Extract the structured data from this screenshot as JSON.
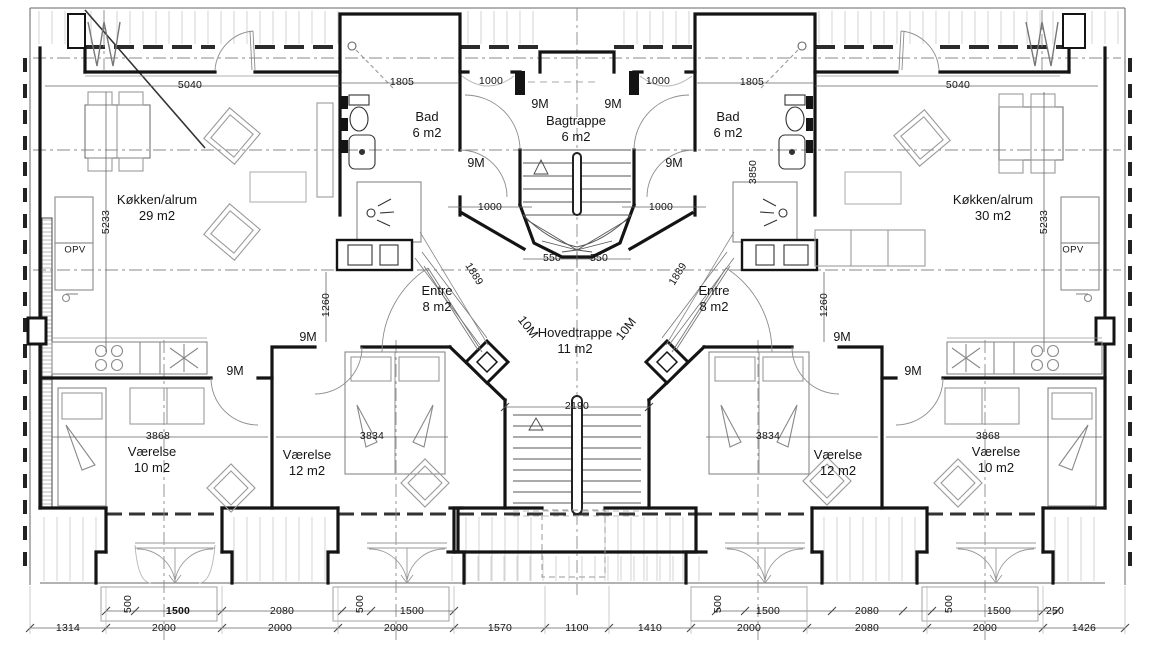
{
  "plan": {
    "rooms": [
      {
        "name": "Køkken/alrum",
        "area": "29 m2",
        "x": 157,
        "y": 208
      },
      {
        "name": "Køkken/alrum",
        "area": "30 m2",
        "x": 993,
        "y": 208
      },
      {
        "name": "Bad",
        "area": "6 m2",
        "x": 427,
        "y": 125
      },
      {
        "name": "Bad",
        "area": "6 m2",
        "x": 728,
        "y": 125
      },
      {
        "name": "Bagtrappe",
        "area": "6 m2",
        "x": 576,
        "y": 129
      },
      {
        "name": "Entre",
        "area": "8 m2",
        "x": 437,
        "y": 299
      },
      {
        "name": "Entre",
        "area": "8 m2",
        "x": 714,
        "y": 299
      },
      {
        "name": "Hovedtrappe",
        "area": "11 m2",
        "x": 575,
        "y": 341
      },
      {
        "name": "Værelse",
        "area": "10 m2",
        "x": 152,
        "y": 460
      },
      {
        "name": "Værelse",
        "area": "12 m2",
        "x": 307,
        "y": 463
      },
      {
        "name": "Værelse",
        "area": "12 m2",
        "x": 838,
        "y": 463
      },
      {
        "name": "Værelse",
        "area": "10 m2",
        "x": 996,
        "y": 460
      }
    ],
    "closets": [
      {
        "label": "OPV",
        "x": 75,
        "y": 250
      },
      {
        "label": "OPV",
        "x": 1073,
        "y": 250
      }
    ],
    "door_modules": [
      {
        "label": "9M",
        "x": 540,
        "y": 104,
        "rot": 0
      },
      {
        "label": "9M",
        "x": 613,
        "y": 104,
        "rot": 0
      },
      {
        "label": "9M",
        "x": 476,
        "y": 163,
        "rot": 0
      },
      {
        "label": "9M",
        "x": 674,
        "y": 163,
        "rot": 0
      },
      {
        "label": "9M",
        "x": 308,
        "y": 337,
        "rot": 0
      },
      {
        "label": "9M",
        "x": 842,
        "y": 337,
        "rot": 0
      },
      {
        "label": "9M",
        "x": 235,
        "y": 371,
        "rot": 0
      },
      {
        "label": "9M",
        "x": 913,
        "y": 371,
        "rot": 0
      },
      {
        "label": "10M",
        "x": 528,
        "y": 327,
        "rot": 52
      },
      {
        "label": "10M",
        "x": 626,
        "y": 329,
        "rot": -52
      }
    ],
    "dimensions": [
      {
        "text": "5040",
        "x": 190,
        "y": 85,
        "rot": 0
      },
      {
        "text": "5040",
        "x": 958,
        "y": 85,
        "rot": 0
      },
      {
        "text": "1805",
        "x": 402,
        "y": 82,
        "rot": 0
      },
      {
        "text": "1805",
        "x": 752,
        "y": 82,
        "rot": 0
      },
      {
        "text": "1000",
        "x": 491,
        "y": 81,
        "rot": 0
      },
      {
        "text": "1000",
        "x": 658,
        "y": 81,
        "rot": 0
      },
      {
        "text": "1000",
        "x": 490,
        "y": 207,
        "rot": 0
      },
      {
        "text": "1000",
        "x": 661,
        "y": 207,
        "rot": 0
      },
      {
        "text": "550",
        "x": 552,
        "y": 258,
        "rot": 0
      },
      {
        "text": "550",
        "x": 599,
        "y": 258,
        "rot": 0
      },
      {
        "text": "5233",
        "x": 106,
        "y": 222,
        "rot": -90
      },
      {
        "text": "5233",
        "x": 1044,
        "y": 222,
        "rot": -90
      },
      {
        "text": "3850",
        "x": 753,
        "y": 172,
        "rot": -90
      },
      {
        "text": "1260",
        "x": 326,
        "y": 305,
        "rot": -90
      },
      {
        "text": "1260",
        "x": 824,
        "y": 305,
        "rot": -90
      },
      {
        "text": "1889",
        "x": 474,
        "y": 274,
        "rot": 58
      },
      {
        "text": "1889",
        "x": 678,
        "y": 274,
        "rot": -58
      },
      {
        "text": "2190",
        "x": 577,
        "y": 406,
        "rot": 0
      },
      {
        "text": "3868",
        "x": 158,
        "y": 436,
        "rot": 0
      },
      {
        "text": "3834",
        "x": 372,
        "y": 436,
        "rot": 0
      },
      {
        "text": "3834",
        "x": 768,
        "y": 436,
        "rot": 0
      },
      {
        "text": "3868",
        "x": 988,
        "y": 436,
        "rot": 0
      }
    ],
    "bottom_dims_row1": [
      {
        "text": "500",
        "x": 128,
        "y": 604,
        "rot": -90
      },
      {
        "text": "1500",
        "x": 178,
        "y": 611,
        "rot": 0,
        "bold": true
      },
      {
        "text": "2080",
        "x": 282,
        "y": 611,
        "rot": 0
      },
      {
        "text": "500",
        "x": 360,
        "y": 604,
        "rot": -90
      },
      {
        "text": "1500",
        "x": 412,
        "y": 611,
        "rot": 0
      },
      {
        "text": "500",
        "x": 718,
        "y": 604,
        "rot": -90
      },
      {
        "text": "1500",
        "x": 768,
        "y": 611,
        "rot": 0
      },
      {
        "text": "2080",
        "x": 867,
        "y": 611,
        "rot": 0
      },
      {
        "text": "500",
        "x": 949,
        "y": 604,
        "rot": -90
      },
      {
        "text": "1500",
        "x": 999,
        "y": 611,
        "rot": 0
      },
      {
        "text": "250",
        "x": 1055,
        "y": 611,
        "rot": 0
      }
    ],
    "bottom_dims_row2": [
      {
        "text": "1314",
        "x": 68,
        "y": 628,
        "rot": 0
      },
      {
        "text": "2000",
        "x": 164,
        "y": 628,
        "rot": 0
      },
      {
        "text": "2000",
        "x": 280,
        "y": 628,
        "rot": 0
      },
      {
        "text": "2000",
        "x": 396,
        "y": 628,
        "rot": 0
      },
      {
        "text": "1570",
        "x": 500,
        "y": 628,
        "rot": 0
      },
      {
        "text": "1100",
        "x": 577,
        "y": 628,
        "rot": 0
      },
      {
        "text": "1410",
        "x": 650,
        "y": 628,
        "rot": 0
      },
      {
        "text": "2000",
        "x": 749,
        "y": 628,
        "rot": 0
      },
      {
        "text": "2080",
        "x": 867,
        "y": 628,
        "rot": 0
      },
      {
        "text": "2000",
        "x": 985,
        "y": 628,
        "rot": 0
      },
      {
        "text": "1426",
        "x": 1084,
        "y": 628,
        "rot": 0
      }
    ]
  }
}
